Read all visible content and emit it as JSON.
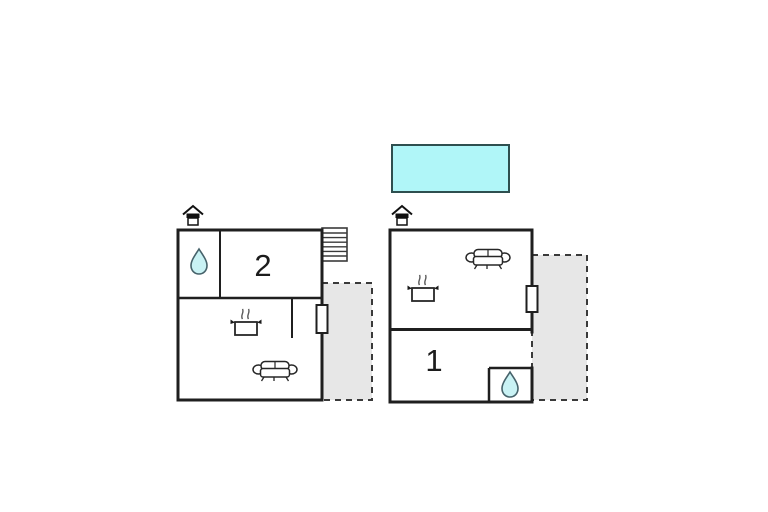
{
  "floorplan": {
    "background": "#ffffff",
    "wall_color": "#1f1f1f",
    "terrace_fill": "#e7e7e7",
    "terrace_dash_color": "#3a3a3a",
    "water_drop_fill": "#c9f2f4",
    "pool": {
      "fill": "#b0f6f8",
      "stroke": "#2e4f4f"
    },
    "units": [
      {
        "label": "2",
        "icons": [
          "entrance-icon",
          "water-drop-icon",
          "stairs-icon",
          "stove-icon",
          "sofa-icon",
          "window",
          "terrace"
        ]
      },
      {
        "label": "1",
        "icons": [
          "entrance-icon",
          "water-drop-icon",
          "stove-icon",
          "sofa-icon",
          "window",
          "terrace"
        ]
      }
    ]
  }
}
